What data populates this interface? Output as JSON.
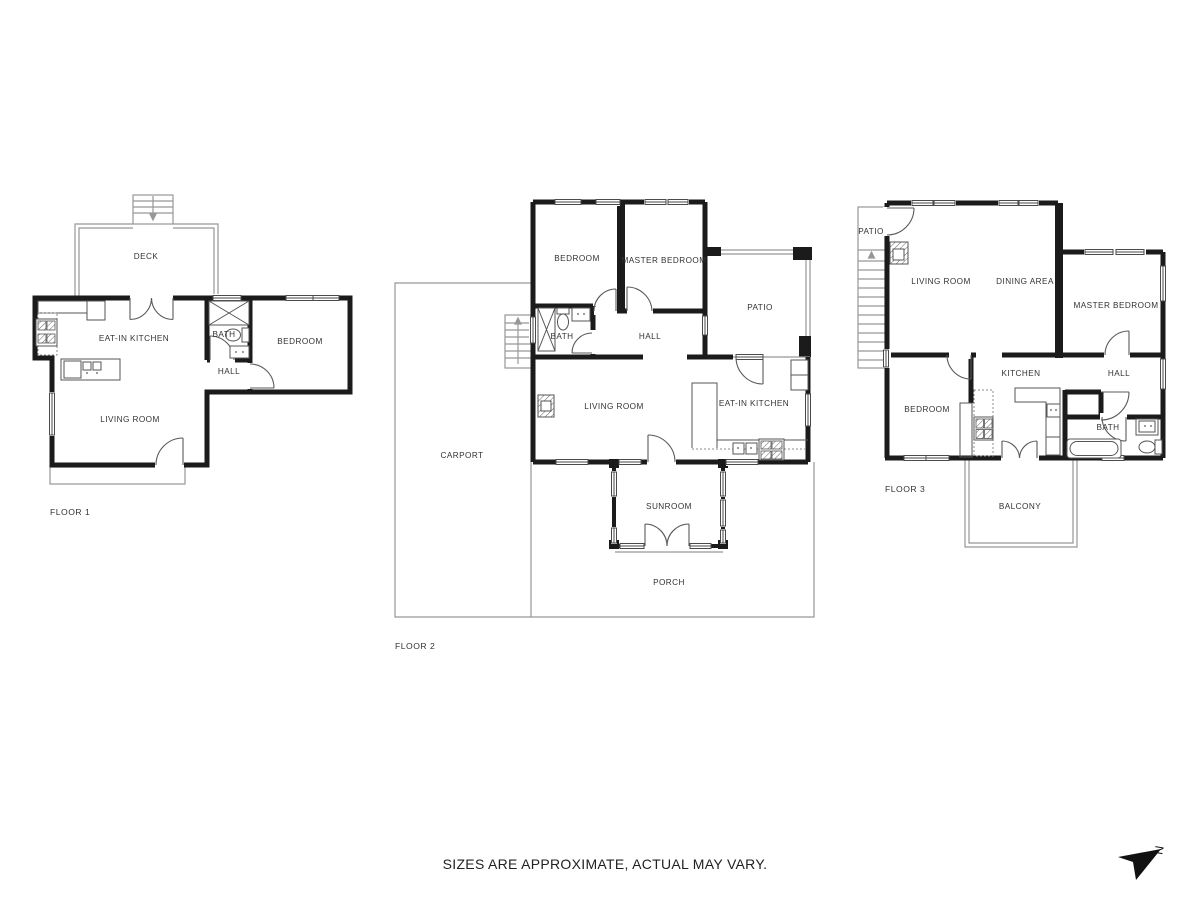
{
  "footer": {
    "disclaimer": "SIZES ARE APPROXIMATE, ACTUAL MAY VARY."
  },
  "compass": {
    "label": "N"
  },
  "colors": {
    "wall": "#1b1b1b",
    "outdoor_line": "#979797",
    "fixture_line": "#555555",
    "text": "#333333"
  },
  "floor1": {
    "label": "FLOOR 1",
    "rooms": {
      "deck": "DECK",
      "kitchen": "EAT-IN KITCHEN",
      "bath": "BATH",
      "bedroom": "BEDROOM",
      "hall": "HALL",
      "living": "LIVING ROOM"
    }
  },
  "floor2": {
    "label": "FLOOR 2",
    "rooms": {
      "bedroom": "BEDROOM",
      "master": "MASTER BEDROOM",
      "patio": "PATIO",
      "bath": "BATH",
      "hall": "HALL",
      "living": "LIVING ROOM",
      "kitchen": "EAT-IN KITCHEN",
      "carport": "CARPORT",
      "sunroom": "SUNROOM",
      "porch": "PORCH"
    }
  },
  "floor3": {
    "label": "FLOOR 3",
    "rooms": {
      "patio": "PATIO",
      "living": "LIVING ROOM",
      "dining": "DINING AREA",
      "master": "MASTER BEDROOM",
      "kitchen": "KITCHEN",
      "hall": "HALL",
      "bedroom": "BEDROOM",
      "bath": "BATH",
      "balcony": "BALCONY"
    }
  }
}
